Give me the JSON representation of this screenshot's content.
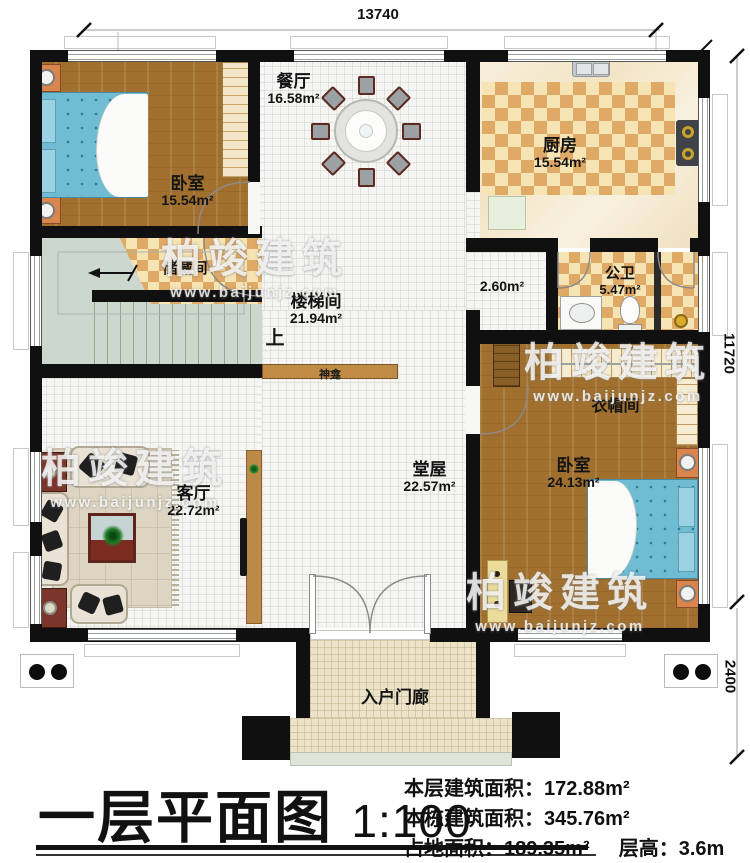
{
  "watermark": {
    "brand": "柏竣建筑",
    "url": "www.baijunjz.com"
  },
  "dimensions": {
    "width_top": "13740",
    "height_main": "11720",
    "height_porch": "2400"
  },
  "rooms": {
    "bedroom1": {
      "name": "卧室",
      "area": "15.54m²"
    },
    "dining": {
      "name": "餐厅",
      "area": "16.58m²"
    },
    "kitchen": {
      "name": "厨房",
      "area": "15.54m²"
    },
    "storage": {
      "name": "储藏间"
    },
    "stairwell": {
      "name": "楼梯间",
      "area": "21.94m²"
    },
    "corridor": {
      "area": "2.60m²"
    },
    "bathroom": {
      "name": "公卫",
      "area": "5.47m²"
    },
    "cloakroom": {
      "name": "衣帽间"
    },
    "bedroom2": {
      "name": "卧室",
      "area": "24.13m²"
    },
    "hall": {
      "name": "堂屋",
      "area": "22.57m²"
    },
    "living": {
      "name": "客厅",
      "area": "22.72m²"
    },
    "porch": {
      "name": "入户门廊"
    },
    "shrine": {
      "name": "神龛"
    },
    "stairs_up": {
      "label": "上"
    }
  },
  "title_block": {
    "title": "一层平面图",
    "scale": "1:100",
    "stat1_label": "本层建筑面积：",
    "stat1_value": "172.88m²",
    "stat2_label": "本栋建筑面积：",
    "stat2_value": "345.76m²",
    "stat3_label": "占地面积：",
    "stat3_value": "189.35m²",
    "stat4_label": "层高：",
    "stat4_value": "3.6m"
  },
  "colors": {
    "wall": "#101010",
    "wood": "#a1702e",
    "bed": "#6fbcd3",
    "accent_wood": "#c08b44"
  }
}
